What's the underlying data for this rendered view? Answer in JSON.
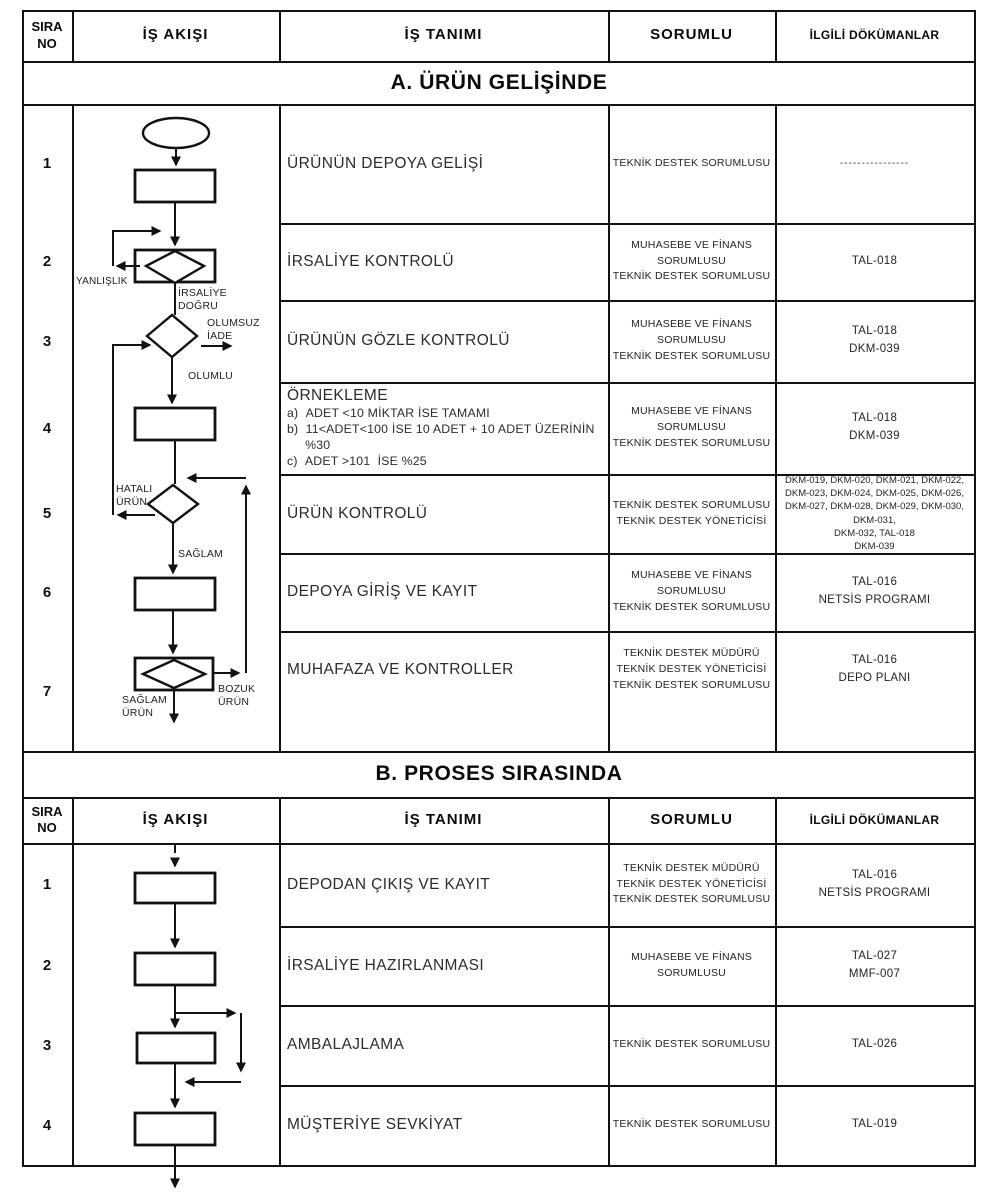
{
  "colors": {
    "ink": "#121212",
    "text": "#2c2c2c"
  },
  "header": {
    "col_sira": "SIRA\nNO",
    "col_akis": "İŞ AKIŞI",
    "col_tanim": "İŞ TANIMI",
    "col_sorumlu": "SORUMLU",
    "col_dokuman": "İLGİLİ DÖKÜMANLAR"
  },
  "section_a": {
    "title": "A. ÜRÜN GELİŞİNDE",
    "rows": [
      {
        "no": "1",
        "tanim": "ÜRÜNÜN DEPOYA GELİŞİ",
        "sorumlu": "TEKNİK DESTEK SORUMLUSU",
        "dokuman": "----------------"
      },
      {
        "no": "2",
        "tanim": "İRSALİYE KONTROLÜ",
        "sorumlu": "MUHASEBE VE FİNANS\nSORUMLUSU\nTEKNİK DESTEK SORUMLUSU",
        "dokuman": "TAL-018"
      },
      {
        "no": "3",
        "tanim": "ÜRÜNÜN GÖZLE KONTROLÜ",
        "sorumlu": "MUHASEBE VE FİNANS\nSORUMLUSU\nTEKNİK DESTEK SORUMLUSU",
        "dokuman": "TAL-018\nDKM-039"
      },
      {
        "no": "4",
        "tanim": "ÖRNEKLEME",
        "tanim_detail": "a)  ADET <10 MİKTAR İSE TAMAMI\nb)  11<ADET<100 İSE 10 ADET + 10 ADET ÜZERİNİN\n     %30\nc)  ADET >101  İSE %25",
        "sorumlu": "MUHASEBE VE FİNANS\nSORUMLUSU\nTEKNİK DESTEK SORUMLUSU",
        "dokuman": "TAL-018\nDKM-039"
      },
      {
        "no": "5",
        "tanim": "ÜRÜN KONTROLÜ",
        "sorumlu": "TEKNİK DESTEK SORUMLUSU\nTEKNİK DESTEK YÖNETİCİSİ",
        "dokuman": "DKM-019, DKM-020, DKM-021, DKM-022,\nDKM-023, DKM-024, DKM-025, DKM-026,\nDKM-027, DKM-028, DKM-029, DKM-030,\nDKM-031,\nDKM-032, TAL-018\nDKM-039"
      },
      {
        "no": "6",
        "tanim": "DEPOYA GİRİŞ VE KAYIT",
        "sorumlu": "MUHASEBE VE FİNANS\nSORUMLUSU\nTEKNİK DESTEK SORUMLUSU",
        "dokuman": "TAL-016\nNETSİS PROGRAMI"
      },
      {
        "no": "7",
        "tanim": "MUHAFAZA VE KONTROLLER",
        "sorumlu": "TEKNİK DESTEK MÜDÜRÜ\nTEKNİK DESTEK YÖNETİCİSİ\nTEKNİK DESTEK SORUMLUSU",
        "dokuman": "TAL-016\nDEPO PLANI"
      }
    ]
  },
  "section_b": {
    "title": "B. PROSES SIRASINDA",
    "rows": [
      {
        "no": "1",
        "tanim": "DEPODAN ÇIKIŞ VE KAYIT",
        "sorumlu": "TEKNİK DESTEK MÜDÜRÜ\nTEKNİK DESTEK YÖNETİCİSİ\nTEKNİK DESTEK SORUMLUSU",
        "dokuman": "TAL-016\nNETSİS PROGRAMI"
      },
      {
        "no": "2",
        "tanim": "İRSALİYE HAZIRLANMASI",
        "sorumlu": "MUHASEBE VE FİNANS\nSORUMLUSU",
        "dokuman": "TAL-027\nMMF-007"
      },
      {
        "no": "3",
        "tanim": "AMBALAJLAMA",
        "sorumlu": "TEKNİK DESTEK SORUMLUSU",
        "dokuman": "TAL-026"
      },
      {
        "no": "4",
        "tanim": "MÜŞTERİYE SEVKİYAT",
        "sorumlu": "TEKNİK DESTEK SORUMLUSU",
        "dokuman": "TAL-019"
      }
    ]
  },
  "flow_labels": {
    "yanlislik": "YANLIŞLIK",
    "irsaliye_dogru": "İRSALİYE\nDOĞRU",
    "olumsuz_iade": "OLUMSUZ\nİADE",
    "olumlu": "OLUMLU",
    "hatali_urun": "HATALI\nÜRÜN",
    "saglam": "SAĞLAM",
    "bozuk_urun": "BOZUK\nÜRÜN",
    "saglam_urun": "SAĞLAM\nÜRÜN"
  }
}
